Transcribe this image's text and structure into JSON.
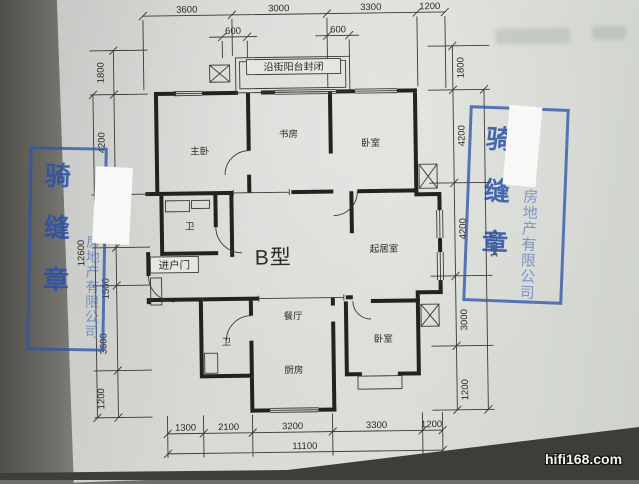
{
  "photo": {
    "watermark": "hifi168.com"
  },
  "plan": {
    "type_label": "B型",
    "balcony_label": "沿街阳台封闭",
    "entry_label": "进户门",
    "rooms": {
      "master_bedroom": "主卧",
      "study": "书房",
      "bedroom_top": "卧室",
      "bath_upper": "卫",
      "living_room": "起居室",
      "dining_room": "餐厅",
      "bath_lower": "卫",
      "kitchen": "厨房",
      "bedroom_bottom": "卧室"
    },
    "dims": {
      "top": [
        "3600",
        "3000",
        "3300",
        "1200"
      ],
      "top_sub": [
        "600",
        "600"
      ],
      "bottom": [
        "1300",
        "2100",
        "3200",
        "3300",
        "1200"
      ],
      "bottom_total": "11100",
      "left": [
        "1800",
        "4200",
        "1500",
        "3600",
        "1200"
      ],
      "left_total": "12600",
      "right": [
        "1800",
        "4200",
        "4200",
        "3000",
        "1200"
      ],
      "right_total": "12600"
    }
  },
  "stamps": {
    "left": {
      "seal_text": "骑缝章",
      "company_text": "房地产有限公司"
    },
    "right": {
      "seal_text": "骑缝章",
      "company_text": "房地产有限公司"
    }
  },
  "colors": {
    "stamp_blue": "#3f6bbd",
    "paper": "#d8dad5",
    "line_dark": "#23221f"
  }
}
